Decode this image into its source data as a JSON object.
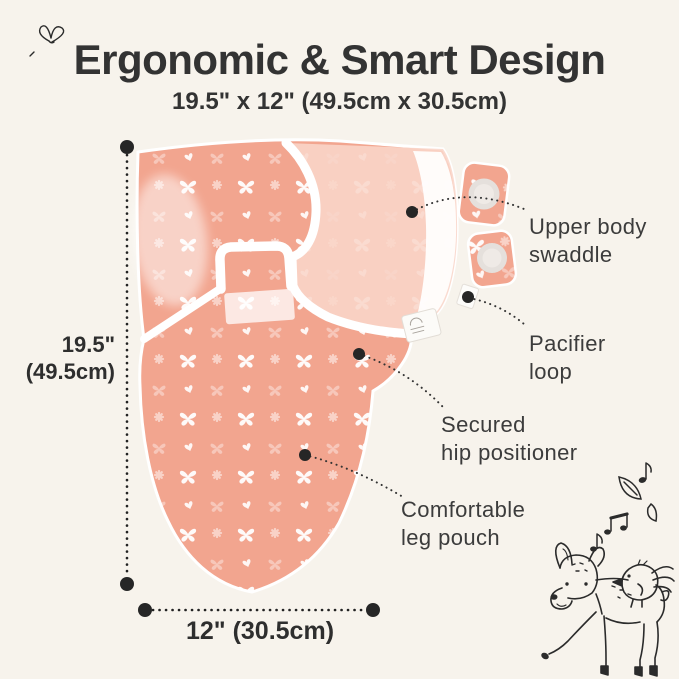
{
  "header": {
    "title": "Ergonomic & Smart Design",
    "subtitle": "19.5\" x 12\" (49.5cm x 30.5cm)"
  },
  "dimensions": {
    "height": {
      "line1": "19.5\"",
      "line2": "(49.5cm)"
    },
    "width": {
      "label": "12\" (30.5cm)"
    }
  },
  "callouts": [
    {
      "id": "upper-body-swaddle",
      "line1": "Upper body",
      "line2": "swaddle"
    },
    {
      "id": "pacifier-loop",
      "line1": "Pacifier",
      "line2": "loop"
    },
    {
      "id": "secured-hip-positioner",
      "line1": "Secured",
      "line2": "hip positioner"
    },
    {
      "id": "comfortable-leg-pouch",
      "line1": "Comfortable",
      "line2": "leg pouch"
    }
  ],
  "decorations": [
    "butterfly-doodle-icon",
    "music-notes-icon",
    "leaf-doodle-icon",
    "deer-and-bird-doodle-icon",
    "brand-tag",
    "pacifier-loop-tag"
  ],
  "pattern_motifs": [
    "butterfly",
    "daisy",
    "heart"
  ],
  "colors": {
    "background": "#f7f3ec",
    "swaddle_main": "#f2a58f",
    "swaddle_wing": "#f9d6ca",
    "trim": "#ffffff",
    "tab_circle": "#e5e0dc",
    "text_dark": "#333333",
    "callout_text": "#3c3c3c",
    "dot": "#262626"
  }
}
